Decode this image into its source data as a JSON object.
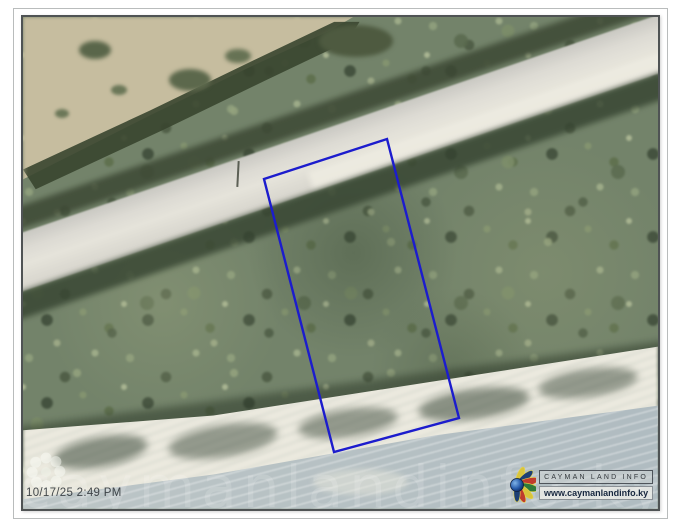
{
  "meta": {
    "timestamp": "10/17/25 2:49 PM"
  },
  "branding": {
    "org_name": "CAYMAN LAND INFO",
    "website": "www.caymanlandinfo.ky"
  },
  "watermark": {
    "text": "caymanlandinfo.ky"
  },
  "map": {
    "parcel": {
      "points": "241,162 364,122 436,401 311,435",
      "outline_color": "#1c1ccd"
    },
    "palette": {
      "vegetation": "#73836a",
      "lagoon": "#c6bd9f",
      "road": "#dcdad3",
      "sand": "#eceadf",
      "sea": "#b7c1c4"
    }
  }
}
